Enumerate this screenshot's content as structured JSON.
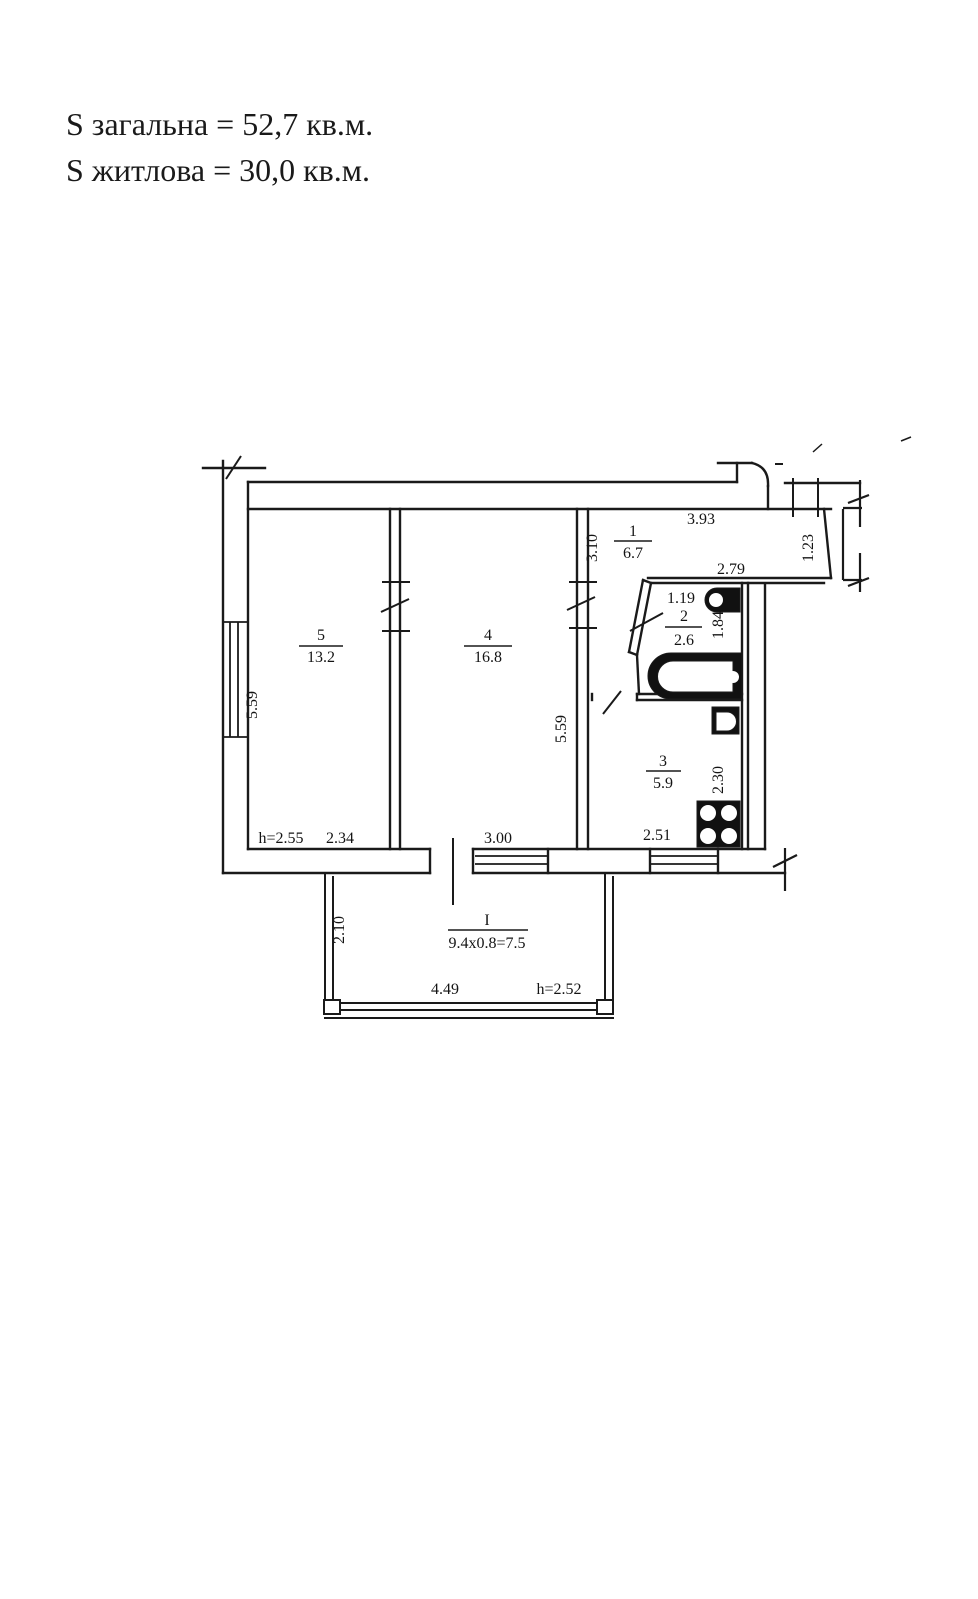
{
  "header": {
    "total_area": "S загальна = 52,7 кв.м.",
    "living_area": "S житлова = 30,0 кв.м."
  },
  "rooms": {
    "living1": {
      "number": "5",
      "area": "13.2"
    },
    "living2": {
      "number": "4",
      "area": "16.8"
    },
    "hall": {
      "number": "1",
      "area": "6.7"
    },
    "bathroom": {
      "number": "2",
      "area": "2.6"
    },
    "kitchen": {
      "number": "3",
      "area": "5.9"
    },
    "balcony": {
      "number": "I",
      "area": "9.4x0.8=7.5"
    }
  },
  "dimensions": {
    "room5_wall_left": "5.59",
    "room4_wall_right": "5.59",
    "hall_width": "3.10",
    "hall_length": "3.93",
    "hall_right": "1.23",
    "bathroom_top": "2.79",
    "bathroom_entry": "1.19",
    "bathroom_right": "1.84",
    "kitchen_depth": "2.30",
    "kitchen_width": "2.51",
    "room5_height": "h=2.55",
    "room5_width": "2.34",
    "room4_width": "3.00",
    "balcony_depth": "2.10",
    "balcony_width": "4.49",
    "balcony_height": "h=2.52"
  },
  "icons": {
    "bathtub": "bathtub-icon",
    "toilet": "toilet-icon",
    "sink": "sink-icon",
    "stove": "stove-icon"
  },
  "colors": {
    "line": "#1a1a1a",
    "background": "#ffffff"
  }
}
